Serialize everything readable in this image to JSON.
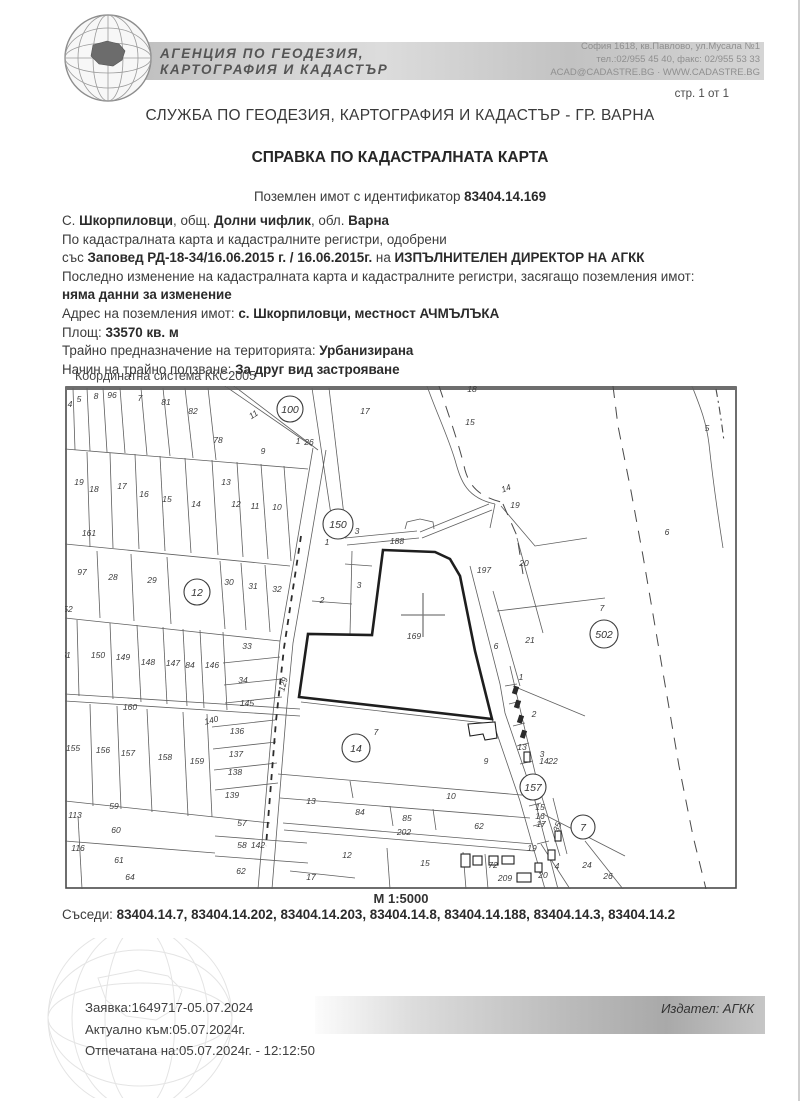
{
  "header": {
    "agency_name_line1": "АГЕНЦИЯ ПО ГЕОДЕЗИЯ,",
    "agency_name_line2": "КАРТОГРАФИЯ И КАДАСТЪР",
    "address_line1": "София 1618, кв.Павлово, ул.Мусала №1",
    "address_line2": "тел.:02/955 45 40, факс: 02/955 53 33",
    "address_line3": "ACAD@CADASTRE.BG · WWW.CADASTRE.BG",
    "page_indicator": "стр. 1 от 1",
    "office_title": "СЛУЖБА ПО ГЕОДЕЗИЯ, КАРТОГРАФИЯ И КАДАСТЪР - ГР. ВАРНА",
    "document_title": "СПРАВКА ПО КАДАСТРАЛНАТА КАРТА"
  },
  "property": {
    "intro_regular": "Поземлен имот с  идентификатор ",
    "identifier": "83404.14.169",
    "info_lines": [
      [
        {
          "t": "С. ",
          "b": false
        },
        {
          "t": "Шкорпиловци",
          "b": true
        },
        {
          "t": ", общ. ",
          "b": false
        },
        {
          "t": "Долни чифлик",
          "b": true
        },
        {
          "t": ", обл. ",
          "b": false
        },
        {
          "t": "Варна",
          "b": true
        }
      ],
      [
        {
          "t": "По кадастралната карта и кадастралните регистри, одобрени",
          "b": false
        }
      ],
      [
        {
          "t": "със ",
          "b": false
        },
        {
          "t": "Заповед РД-18-34/16.06.2015 г. / 16.06.2015г.",
          "b": true
        },
        {
          "t": " на ",
          "b": false
        },
        {
          "t": "ИЗПЪЛНИТЕЛЕН ДИРЕКТОР НА АГКК",
          "b": true
        }
      ],
      [
        {
          "t": "Последно изменение на кадастралната карта и кадастралните регистри, засягащо поземления имот:",
          "b": false
        }
      ],
      [
        {
          "t": "няма данни за изменение",
          "b": true
        }
      ],
      [
        {
          "t": "Адрес на поземления имот: ",
          "b": false
        },
        {
          "t": "с. Шкорпиловци, местност АЧМЪЛЪКА",
          "b": true
        }
      ],
      [
        {
          "t": "Площ: ",
          "b": false
        },
        {
          "t": "33570 кв. м",
          "b": true
        }
      ],
      [
        {
          "t": "Трайно предназначение на територията: ",
          "b": false
        },
        {
          "t": "Урбанизирана",
          "b": true
        }
      ],
      [
        {
          "t": "Начин на трайно ползване: ",
          "b": false
        },
        {
          "t": "За друг вид застрояване",
          "b": true
        }
      ]
    ]
  },
  "map": {
    "coordinate_system": "Координатна система ККС2005",
    "scale": "М 1:5000",
    "subject_parcel": "169",
    "labels": [
      {
        "t": "4",
        "x": 5,
        "y": 21
      },
      {
        "t": "5",
        "x": 14,
        "y": 16
      },
      {
        "t": "8",
        "x": 31,
        "y": 13
      },
      {
        "t": "96",
        "x": 47,
        "y": 12
      },
      {
        "t": "7",
        "x": 75,
        "y": 15
      },
      {
        "t": "81",
        "x": 101,
        "y": 19
      },
      {
        "t": "82",
        "x": 128,
        "y": 28
      },
      {
        "t": "78",
        "x": 153,
        "y": 57
      },
      {
        "t": "9",
        "x": 198,
        "y": 68
      },
      {
        "t": "11",
        "x": 190,
        "y": 31,
        "r": -33
      },
      {
        "t": "1",
        "x": 233,
        "y": 58
      },
      {
        "t": "26",
        "x": 244,
        "y": 59
      },
      {
        "t": "17",
        "x": 300,
        "y": 28
      },
      {
        "t": "19",
        "x": 14,
        "y": 99
      },
      {
        "t": "18",
        "x": 29,
        "y": 106
      },
      {
        "t": "17",
        "x": 57,
        "y": 103
      },
      {
        "t": "16",
        "x": 79,
        "y": 111
      },
      {
        "t": "15",
        "x": 102,
        "y": 116
      },
      {
        "t": "14",
        "x": 131,
        "y": 121
      },
      {
        "t": "13",
        "x": 161,
        "y": 99
      },
      {
        "t": "12",
        "x": 171,
        "y": 121
      },
      {
        "t": "11",
        "x": 190,
        "y": 123
      },
      {
        "t": "10",
        "x": 212,
        "y": 124
      },
      {
        "t": "161",
        "x": 24,
        "y": 150
      },
      {
        "t": "97",
        "x": 17,
        "y": 189
      },
      {
        "t": "28",
        "x": 48,
        "y": 194
      },
      {
        "t": "29",
        "x": 87,
        "y": 197
      },
      {
        "t": "30",
        "x": 164,
        "y": 199
      },
      {
        "t": "31",
        "x": 188,
        "y": 203
      },
      {
        "t": "32",
        "x": 212,
        "y": 206
      },
      {
        "t": "52",
        "x": 3,
        "y": 226
      },
      {
        "t": "51",
        "x": 1,
        "y": 272
      },
      {
        "t": "150",
        "x": 33,
        "y": 272
      },
      {
        "t": "149",
        "x": 58,
        "y": 274
      },
      {
        "t": "148",
        "x": 83,
        "y": 279
      },
      {
        "t": "147",
        "x": 108,
        "y": 280
      },
      {
        "t": "84",
        "x": 125,
        "y": 282
      },
      {
        "t": "146",
        "x": 147,
        "y": 282
      },
      {
        "t": "33",
        "x": 182,
        "y": 263
      },
      {
        "t": "34",
        "x": 178,
        "y": 297
      },
      {
        "t": "145",
        "x": 182,
        "y": 320
      },
      {
        "t": "129",
        "x": 221,
        "y": 299,
        "r": -75
      },
      {
        "t": "160",
        "x": 65,
        "y": 324
      },
      {
        "t": "155",
        "x": 8,
        "y": 365
      },
      {
        "t": "156",
        "x": 38,
        "y": 367
      },
      {
        "t": "157",
        "x": 63,
        "y": 370
      },
      {
        "t": "158",
        "x": 100,
        "y": 374
      },
      {
        "t": "159",
        "x": 132,
        "y": 378
      },
      {
        "t": "140",
        "x": 147,
        "y": 337,
        "r": -14
      },
      {
        "t": "136",
        "x": 172,
        "y": 348
      },
      {
        "t": "137",
        "x": 171,
        "y": 371
      },
      {
        "t": "138",
        "x": 170,
        "y": 389
      },
      {
        "t": "139",
        "x": 167,
        "y": 412
      },
      {
        "t": "59",
        "x": 49,
        "y": 423
      },
      {
        "t": "113",
        "x": 10,
        "y": 432
      },
      {
        "t": "60",
        "x": 51,
        "y": 447
      },
      {
        "t": "116",
        "x": 13,
        "y": 465
      },
      {
        "t": "61",
        "x": 54,
        "y": 477
      },
      {
        "t": "64",
        "x": 65,
        "y": 494
      },
      {
        "t": "57",
        "x": 177,
        "y": 440
      },
      {
        "t": "58",
        "x": 177,
        "y": 462
      },
      {
        "t": "142",
        "x": 193,
        "y": 462
      },
      {
        "t": "62",
        "x": 176,
        "y": 488
      },
      {
        "t": "17",
        "x": 246,
        "y": 494
      },
      {
        "t": "12",
        "x": 282,
        "y": 472
      },
      {
        "t": "15",
        "x": 360,
        "y": 480
      },
      {
        "t": "13",
        "x": 246,
        "y": 418
      },
      {
        "t": "10",
        "x": 386,
        "y": 413
      },
      {
        "t": "84",
        "x": 295,
        "y": 429
      },
      {
        "t": "85",
        "x": 342,
        "y": 435
      },
      {
        "t": "202",
        "x": 339,
        "y": 449
      },
      {
        "t": "62",
        "x": 414,
        "y": 443
      },
      {
        "t": "72",
        "x": 428,
        "y": 482
      },
      {
        "t": "209",
        "x": 440,
        "y": 495
      },
      {
        "t": "9",
        "x": 421,
        "y": 378
      },
      {
        "t": "7",
        "x": 311,
        "y": 349
      },
      {
        "t": "169",
        "x": 349,
        "y": 253
      },
      {
        "t": "188",
        "x": 332,
        "y": 158
      },
      {
        "t": "1",
        "x": 262,
        "y": 159
      },
      {
        "t": "3",
        "x": 292,
        "y": 148
      },
      {
        "t": "3",
        "x": 294,
        "y": 202
      },
      {
        "t": "2",
        "x": 257,
        "y": 217
      },
      {
        "t": "197",
        "x": 419,
        "y": 187
      },
      {
        "t": "20",
        "x": 459,
        "y": 180
      },
      {
        "t": "21",
        "x": 465,
        "y": 257
      },
      {
        "t": "6",
        "x": 431,
        "y": 263
      },
      {
        "t": "19",
        "x": 450,
        "y": 122
      },
      {
        "t": "14",
        "x": 442,
        "y": 105,
        "r": -20
      },
      {
        "t": "15",
        "x": 405,
        "y": 39
      },
      {
        "t": "18",
        "x": 407,
        "y": 6
      },
      {
        "t": "5",
        "x": 642,
        "y": 45
      },
      {
        "t": "6",
        "x": 602,
        "y": 149
      },
      {
        "t": "7",
        "x": 537,
        "y": 225
      },
      {
        "t": "1",
        "x": 456,
        "y": 294
      },
      {
        "t": "2",
        "x": 469,
        "y": 331
      },
      {
        "t": "13",
        "x": 457,
        "y": 364
      },
      {
        "t": "3",
        "x": 477,
        "y": 371
      },
      {
        "t": "14",
        "x": 479,
        "y": 378
      },
      {
        "t": "22",
        "x": 488,
        "y": 378
      },
      {
        "t": "15",
        "x": 475,
        "y": 424
      },
      {
        "t": "16",
        "x": 475,
        "y": 433
      },
      {
        "t": "17",
        "x": 476,
        "y": 441
      },
      {
        "t": "19",
        "x": 467,
        "y": 465
      },
      {
        "t": "20",
        "x": 478,
        "y": 492
      },
      {
        "t": "4",
        "x": 492,
        "y": 483
      },
      {
        "t": "35",
        "x": 495,
        "y": 442,
        "r": -70
      },
      {
        "t": "24",
        "x": 522,
        "y": 482
      },
      {
        "t": "26",
        "x": 543,
        "y": 493
      }
    ],
    "circled_labels": [
      {
        "t": "100",
        "x": 225,
        "y": 23,
        "radius": 13
      },
      {
        "t": "150",
        "x": 273,
        "y": 138,
        "radius": 15
      },
      {
        "t": "12",
        "x": 132,
        "y": 206,
        "radius": 13
      },
      {
        "t": "502",
        "x": 539,
        "y": 248,
        "radius": 14
      },
      {
        "t": "14",
        "x": 291,
        "y": 362,
        "radius": 14
      },
      {
        "t": "157",
        "x": 468,
        "y": 401,
        "radius": 13
      },
      {
        "t": "7",
        "x": 518,
        "y": 441,
        "radius": 12
      }
    ]
  },
  "neighbors": {
    "label": "Съседи: ",
    "value": "83404.14.7, 83404.14.202, 83404.14.203, 83404.14.8, 83404.14.188, 83404.14.3, 83404.14.2"
  },
  "footer": {
    "request": "Заявка:1649717-05.07.2024",
    "valid_as_of": "Актуално към:05.07.2024г.",
    "printed_on": "Отпечатана на:05.07.2024г. - 12:12:50",
    "issuer": "Издател: АГКК"
  },
  "colors": {
    "header_band_gray": "#c8c8c8",
    "text": "#3c3c3c",
    "map_line": "#5f5f5f",
    "subject_outline": "#1e1e1e"
  }
}
